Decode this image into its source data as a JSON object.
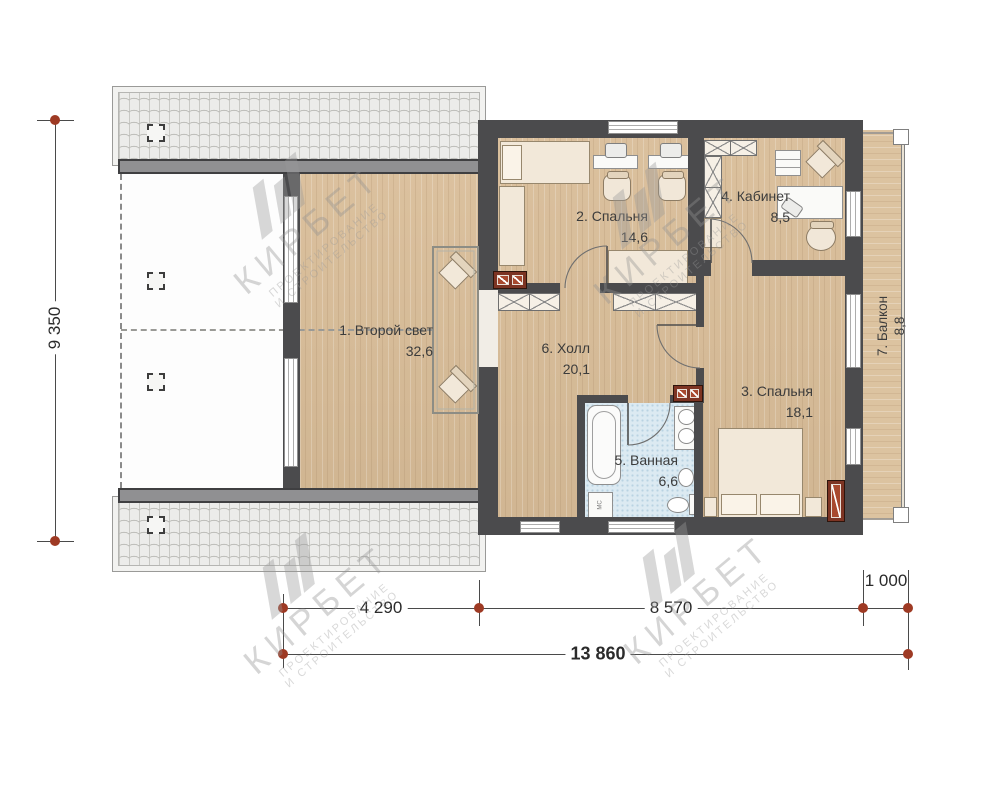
{
  "plan": {
    "rooms": [
      {
        "id": "second-light",
        "label": "1. Второй свет",
        "area": "32,6"
      },
      {
        "id": "bedroom-2",
        "label": "2. Спальня",
        "area": "14,6"
      },
      {
        "id": "bedroom-3",
        "label": "3. Спальня",
        "area": "18,1"
      },
      {
        "id": "office",
        "label": "4. Кабинет",
        "area": "8,5"
      },
      {
        "id": "bathroom",
        "label": "5. Ванная",
        "area": "6,6"
      },
      {
        "id": "hall",
        "label": "6. Холл",
        "area": "20,1"
      },
      {
        "id": "balcony",
        "label": "7. Балкон",
        "area": "8,8"
      }
    ],
    "dims": {
      "v_total": "9 350",
      "seg_a": "4 290",
      "seg_b": "8 570",
      "seg_c": "1 000",
      "h_total": "13 860"
    },
    "watermark": {
      "brand": "КИРБЕТ",
      "sub1": "ПРОЕКТИРОВАНИЕ",
      "sub2": "И СТРОИТЕЛЬСТВО"
    },
    "fixtures": {
      "washer": "МС"
    },
    "colors": {
      "wall": "#4b4b4d",
      "wood": "#d9bd98",
      "dim_marker": "#9e3a24",
      "chimney": "#7d3423",
      "bath": "#dceaf2"
    }
  }
}
